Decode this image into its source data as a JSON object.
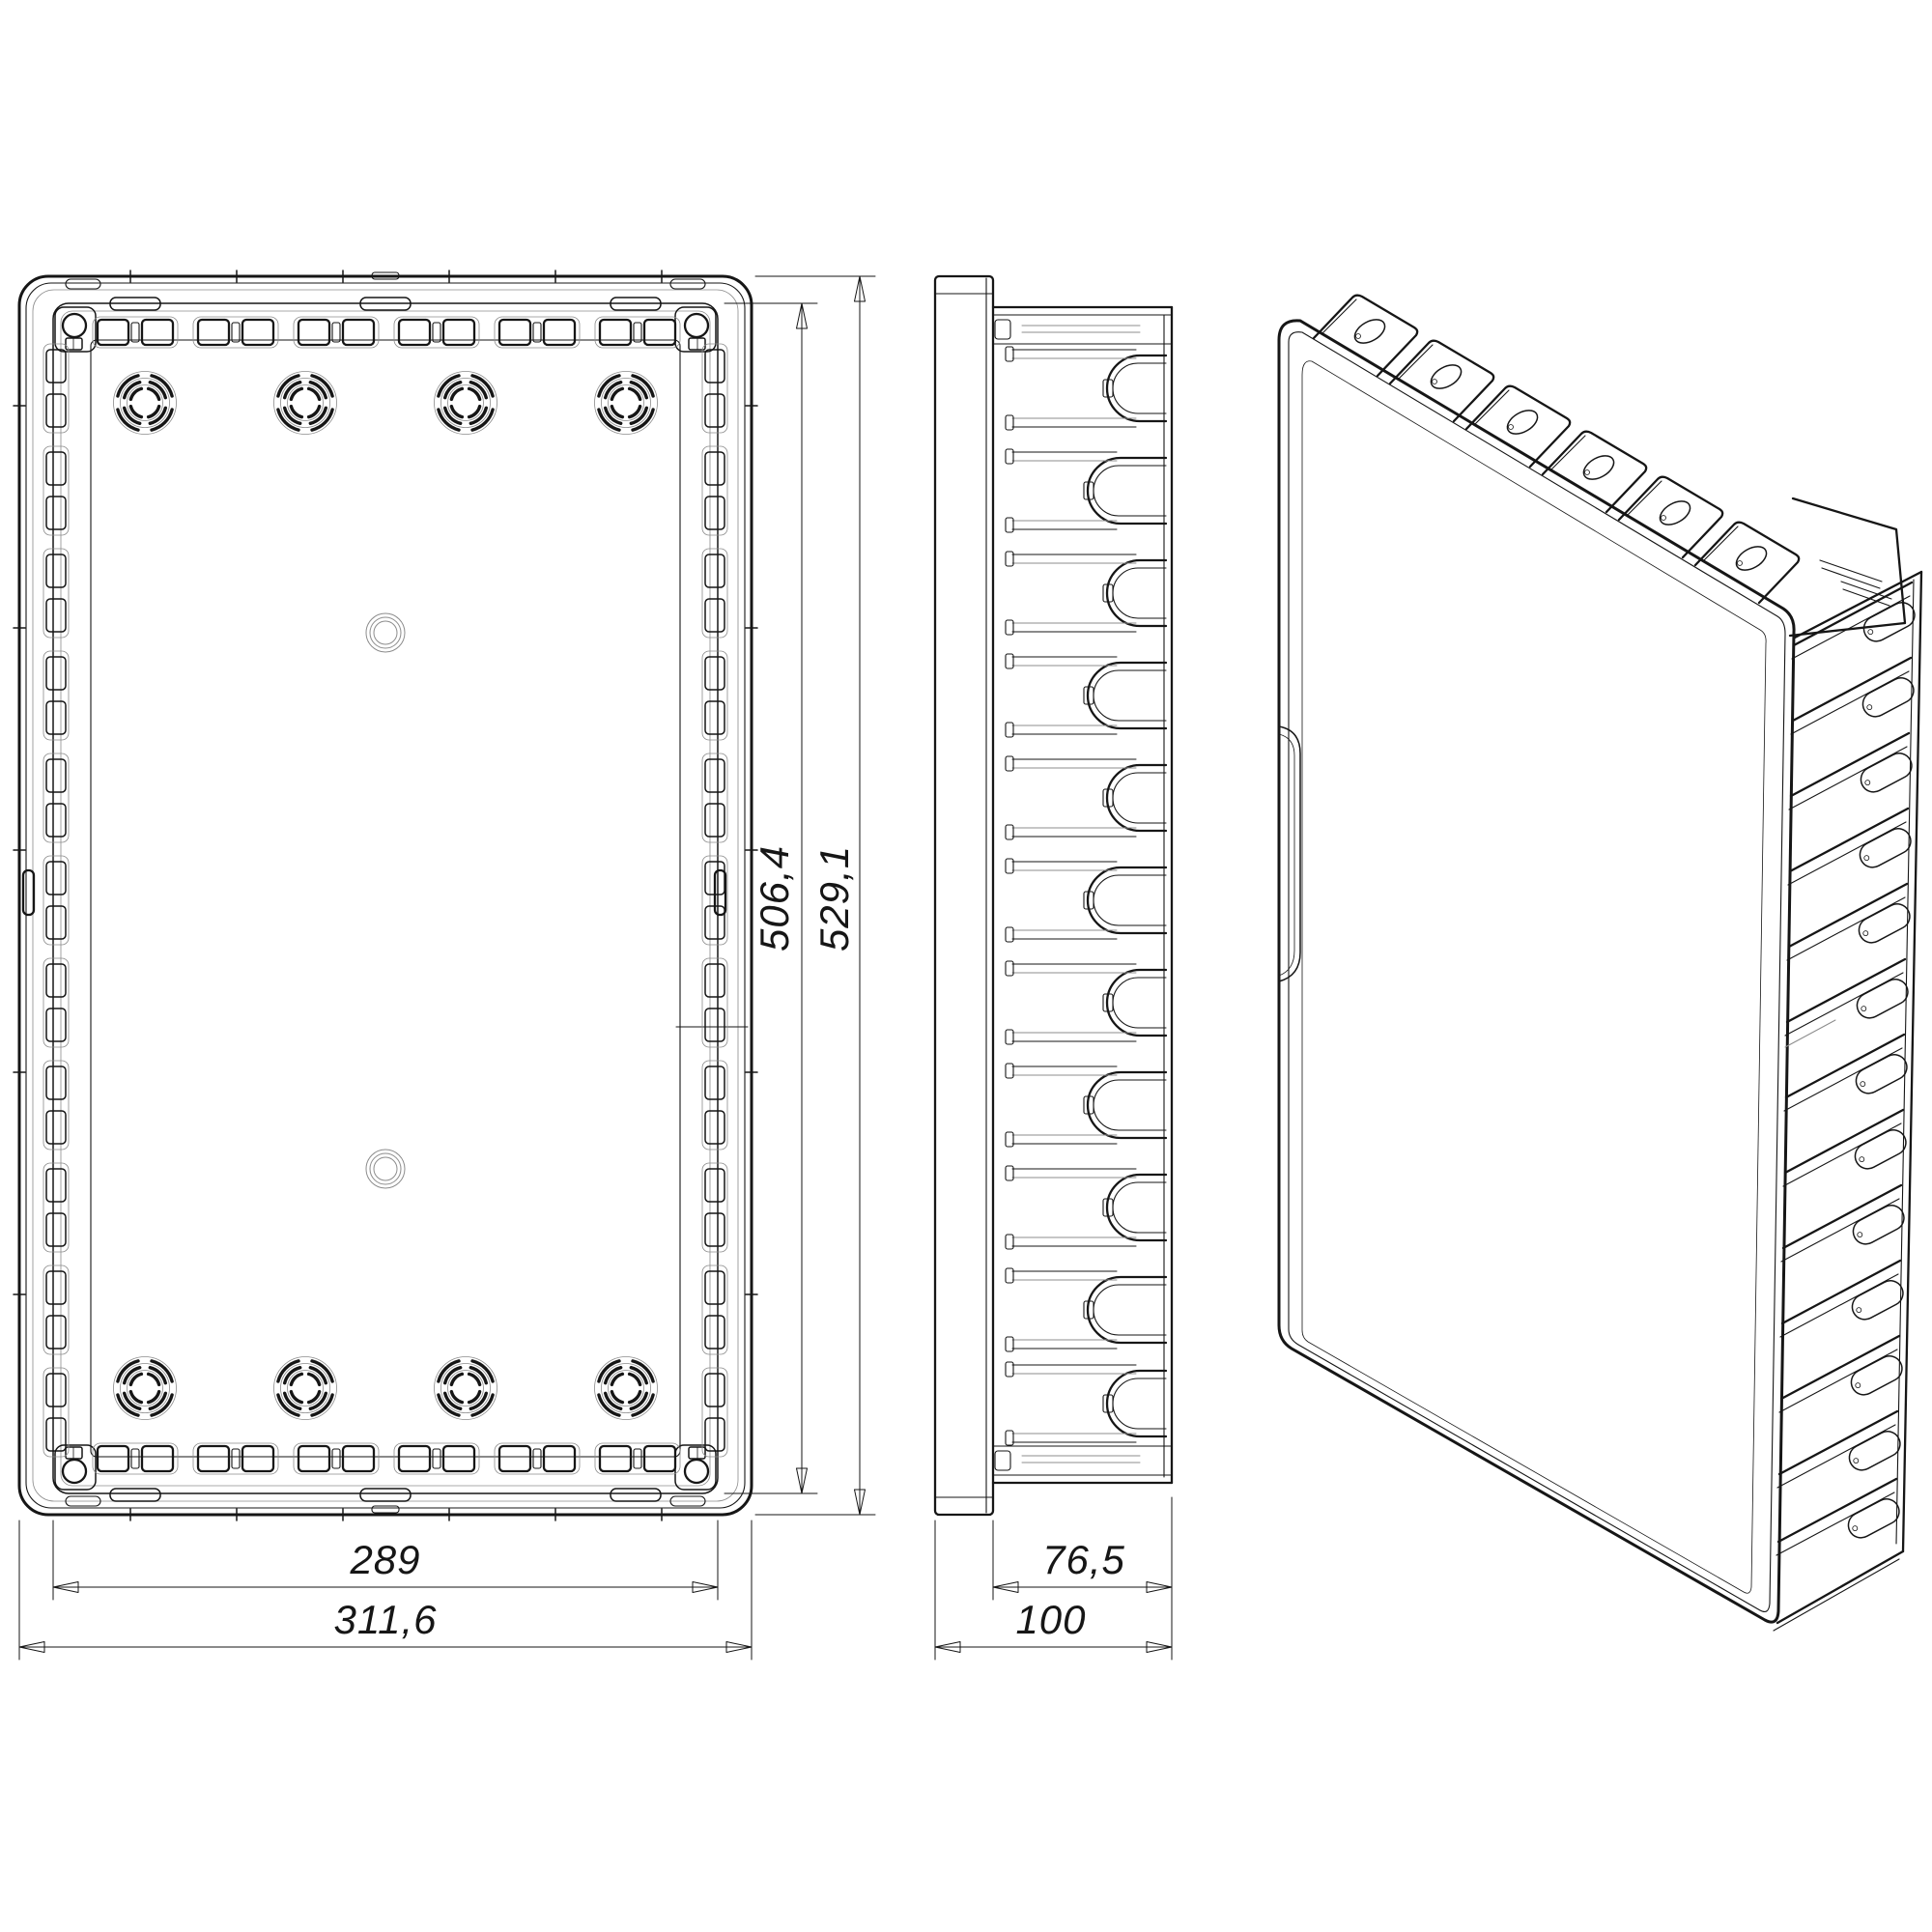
{
  "drawing": {
    "type": "technical-drawing",
    "background": "#ffffff",
    "line_color": "#161616",
    "thin_line_color": "#8c8c8c"
  },
  "dims": {
    "width_body": "289",
    "width_total": "311,6",
    "height_body": "506,4",
    "height_total": "529,1",
    "depth_body": "76,5",
    "depth_total": "100"
  }
}
